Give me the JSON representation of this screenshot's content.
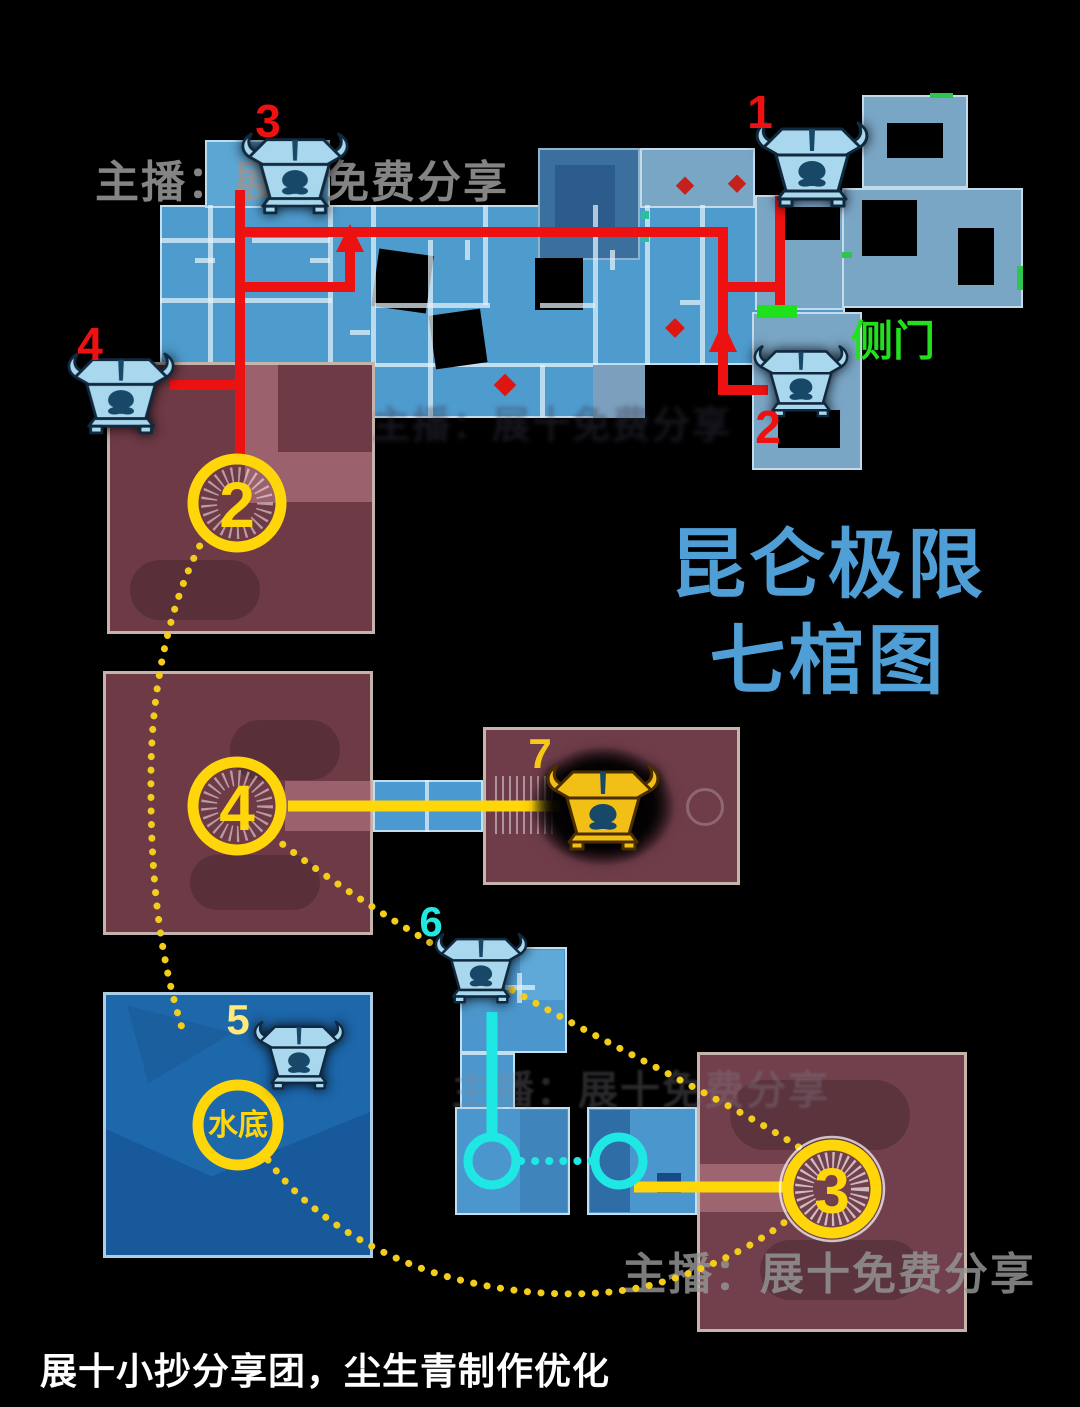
{
  "title": {
    "line1": "昆仑极限",
    "line2": "七棺图"
  },
  "side_door": {
    "label": "侧门"
  },
  "coffin_labels": {
    "c1": "1",
    "c2": "2",
    "c3": "3",
    "c4": "4",
    "c5": "5",
    "c6": "6",
    "c7": "7"
  },
  "route_circles": {
    "r2": "2",
    "r4": "4",
    "r3": "3",
    "water": "水底"
  },
  "watermark": {
    "text": "主播：展十免费分享"
  },
  "footer": {
    "text": "展十小抄分享团，尘生青制作优化"
  },
  "icons": {
    "blue_coffin": "coffin-icon",
    "gold_coffin": "gold-coffin-icon",
    "side_door_marker": "green-door-marker",
    "enemy_marker": "red-diamond-marker"
  },
  "colors": {
    "route_red": "#ee1111",
    "route_gold": "#ffd60a",
    "route_cyan": "#1fe8e4",
    "door_green": "#1ee11b",
    "title_blue": "#4f9fd6",
    "map_blue": "#4e9bce",
    "map_maroon": "#6d3a46",
    "water_blue": "#1d67ab"
  }
}
